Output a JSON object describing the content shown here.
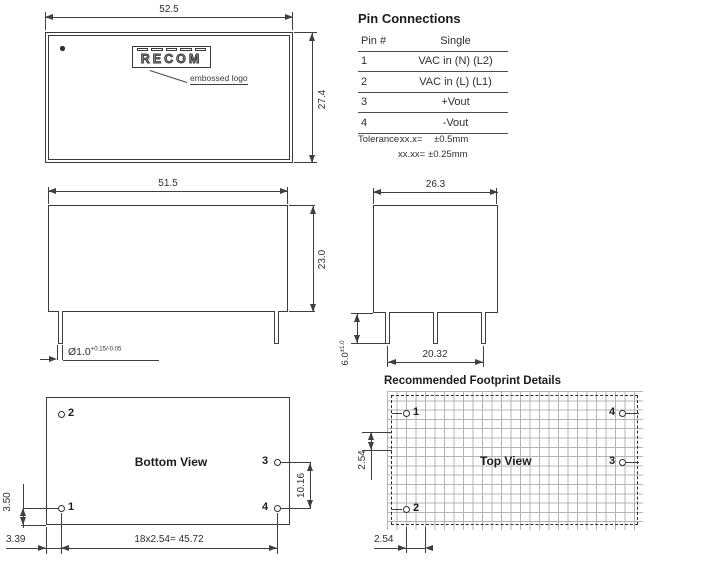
{
  "drawing": {
    "top_view": {
      "width": "52.5",
      "height": "27.4",
      "logo": "RECOM",
      "logo_note": "embossed logo"
    },
    "pin_connections": {
      "title": "Pin Connections",
      "headers": {
        "pin": "Pin #",
        "single": "Single"
      },
      "rows": [
        [
          "1",
          "VAC in (N) (L2)"
        ],
        [
          "2",
          "VAC in (L) (L1)"
        ],
        [
          "3",
          "+Vout"
        ],
        [
          "4",
          "-Vout"
        ]
      ],
      "tolerance": {
        "label": "Tolerance:",
        "line1_fmt": "xx.x=",
        "line1_val": "±0.5mm",
        "line2_fmt": "xx.xx=",
        "line2_val": "±0.25mm"
      }
    },
    "side_view": {
      "width": "51.5",
      "height": "23.0",
      "pin_diameter": "Ø1.0",
      "pin_diameter_tol": "+0.15/-0.05"
    },
    "front_view": {
      "width": "26.3",
      "pin_span": "20.32",
      "pin_length": "6.0",
      "pin_length_tol": "±1.0"
    },
    "bottom_view": {
      "label": "Bottom View",
      "pin1": "1",
      "pin2": "2",
      "pin3": "3",
      "pin4": "4",
      "pin_edge_offset": "3.50",
      "pin_side_offset": "3.39",
      "pin_row_span": "18x2.54= 45.72",
      "out_pin_span": "10.16"
    },
    "footprint": {
      "title": "Recommended Footprint Details",
      "label": "Top View",
      "pin1": "1",
      "pin2": "2",
      "pin3": "3",
      "pin4": "4",
      "grid_pitch_v": "2.54",
      "grid_pitch_h": "2.54"
    }
  }
}
